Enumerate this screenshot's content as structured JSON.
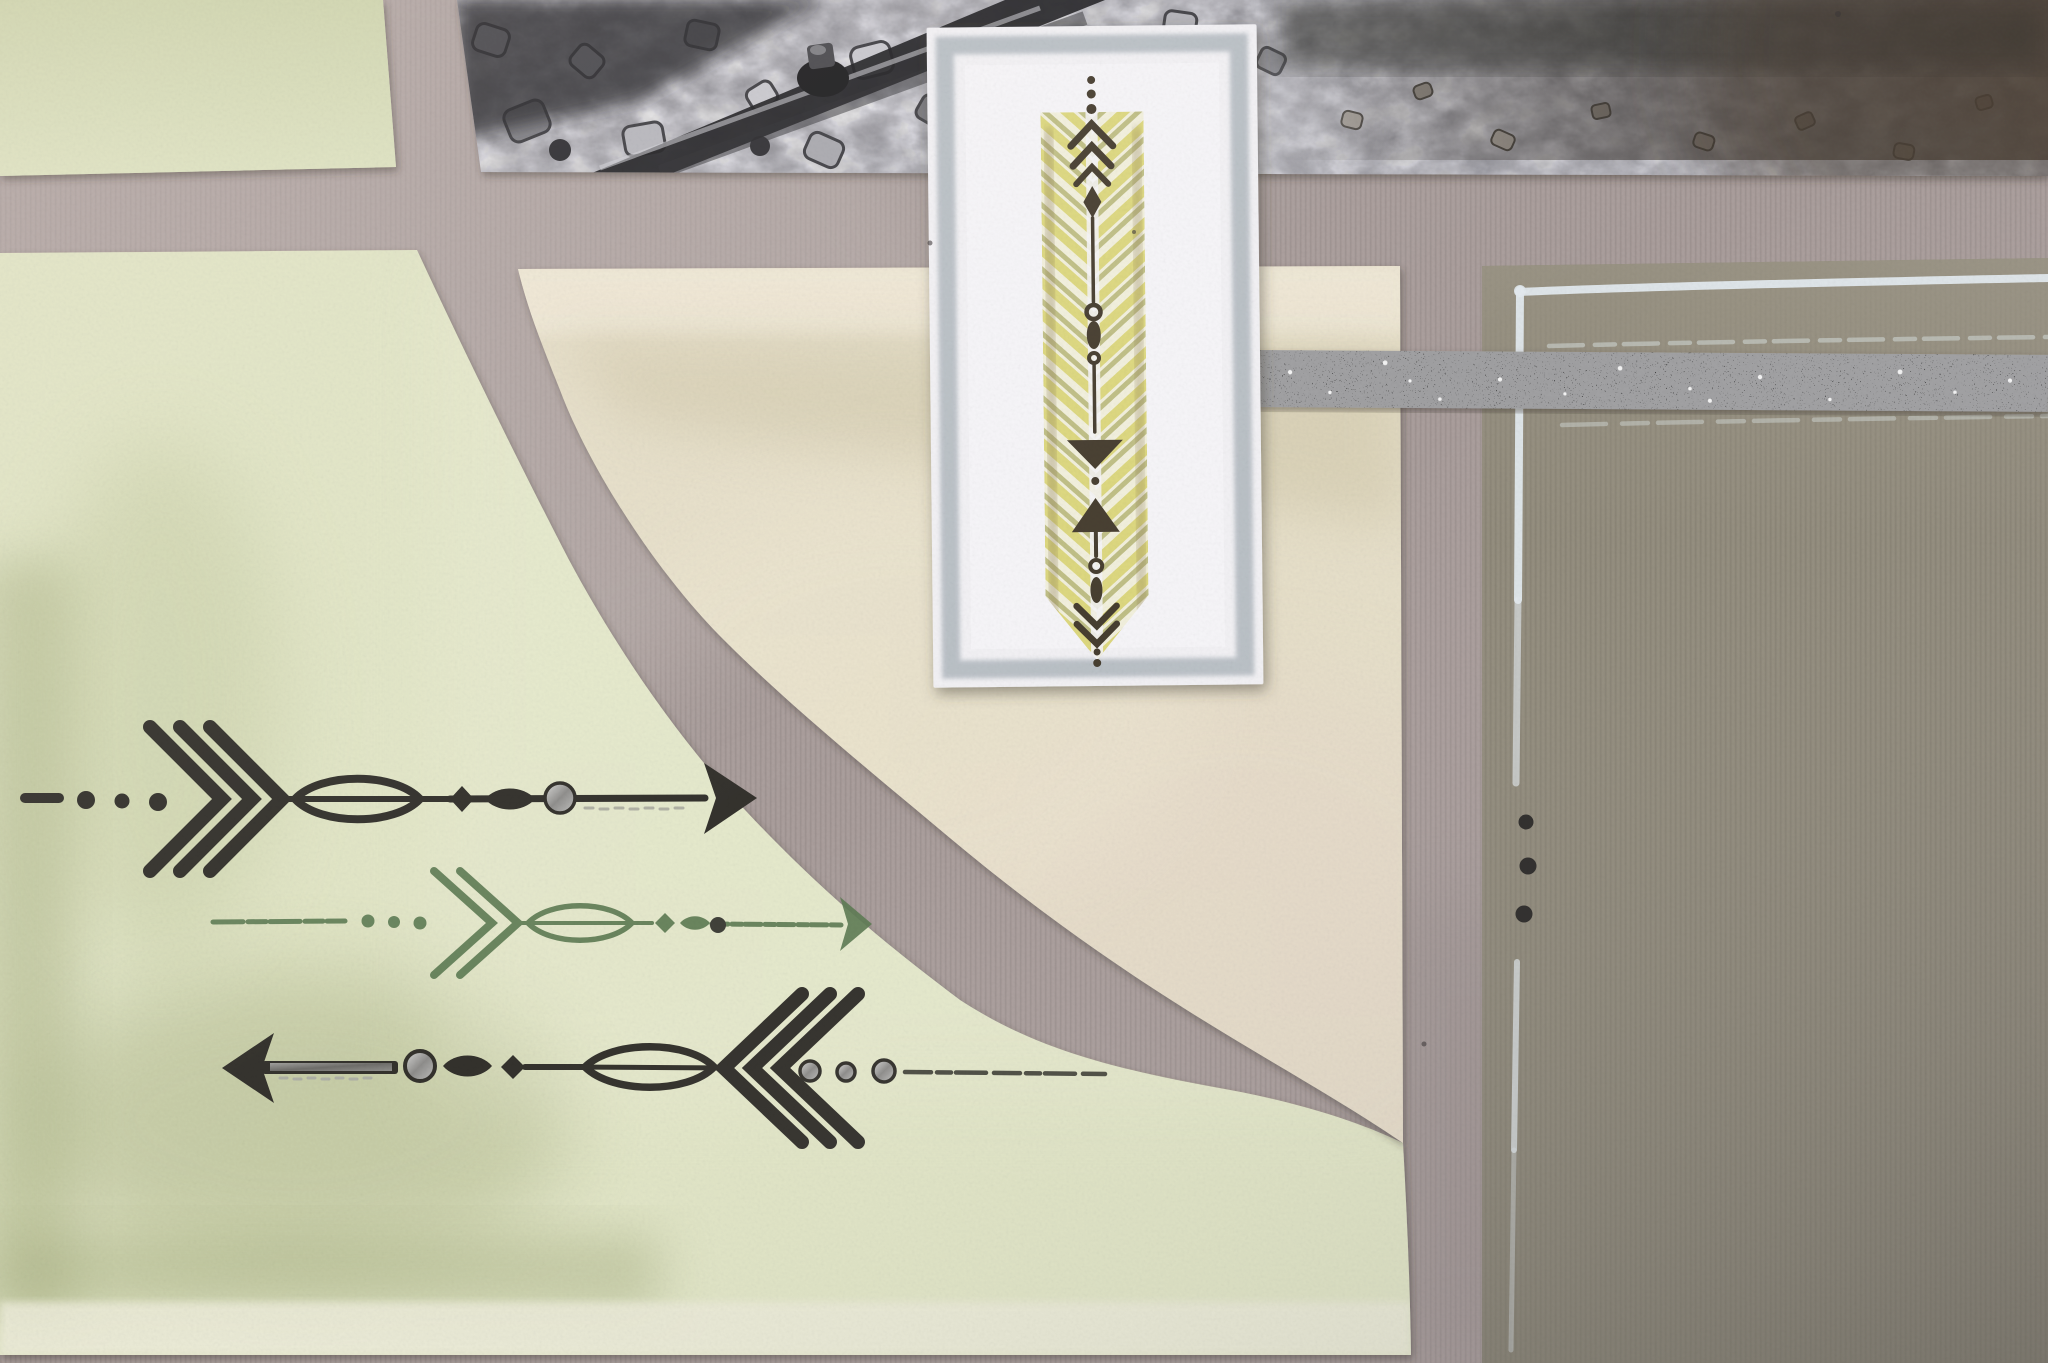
{
  "image": {
    "kind": "photograph",
    "subject": "close-up of a handmade scrapbooking page layout",
    "materials": [
      "textured cardstock",
      "black-and-white photo",
      "black glitter tape",
      "rubber stamp arrows",
      "silver gel pen"
    ]
  },
  "palette": {
    "background_taupe": "#a89c9a",
    "background_taupe_light": "#bcb1ae",
    "panel_green_top": "#d9dfbd",
    "panel_green": "#e1e5c6",
    "panel_green_dark": "#a9b183",
    "panel_green_band": "#ecebd9",
    "panel_cream": "#e6dfc9",
    "panel_cream_light": "#f0e9d8",
    "panel_cream_shade": "#cfc6a8",
    "strip_sage": "#9c9a81",
    "panel_olive": "#908a7a",
    "photo_base": "#97969c",
    "photo_dark": "#26262a",
    "photo_brown": "#4e4237",
    "stone_light": "#c9c9cf",
    "stone_mid": "#84848a",
    "card_white": "#f2f1f4",
    "card_inner": "#f6f5f8",
    "card_silver": "#b5bcc2",
    "feather_yellow": "#d8d168",
    "feather_olive": "#a9a85c",
    "feather_brown": "#8d7b57",
    "card_ink": "#473e30",
    "ink_black": "#33312c",
    "ink_green": "#5d7b53",
    "silver_metallic": "#a7a6a3",
    "tape_black": "#131316",
    "tape_sparkle": "#ffffff",
    "silver_pen": "#e3eaee",
    "silver_pen_faint": "#cfd6d2",
    "pen_dot": "#2c2a28"
  },
  "elements": {
    "background": {
      "label": "taupe textured cardstock background"
    },
    "photo": {
      "label": "black-and-white photo of a railway rail crossing gravel ballast",
      "position": "top edge, full width"
    },
    "green_panel_top": {
      "label": "pale yellow-green cardstock panel",
      "position": "top left corner"
    },
    "green_panel_main": {
      "label": "large pale yellow-green cardstock panel with sweeping curved right edge and darker sponged mottling",
      "position": "lower left"
    },
    "cream_panel": {
      "label": "cream cardstock quarter-circle panel with concave curved edge",
      "position": "center"
    },
    "sage_strip": {
      "label": "sage green mat strip behind the stamped card",
      "position": "center, right of card"
    },
    "olive_panel": {
      "label": "olive cardstock panel",
      "position": "right side"
    },
    "silver_border": {
      "label": "hand-drawn silver pen border on olive panel, vertical line interrupted by three black ink dots",
      "dot_count": 3
    },
    "glitter_tape": {
      "label": "black glitter tape strip running horizontally to the right edge"
    },
    "stamped_card": {
      "label": "white card with sponged silver border, yellow herringbone feather and dark stamped arrow totem pointing down"
    },
    "arrow_stamps": [
      {
        "label": "black tribal arrow stamp pointing right, with chevron fletching, dots and silver bead",
        "ink": "black",
        "direction": "right"
      },
      {
        "label": "green tribal arrow stamp pointing right",
        "ink": "green",
        "direction": "right"
      },
      {
        "label": "black tribal arrow stamp pointing left with silver shaft accent and silver dots",
        "ink": "black",
        "direction": "left"
      }
    ]
  }
}
